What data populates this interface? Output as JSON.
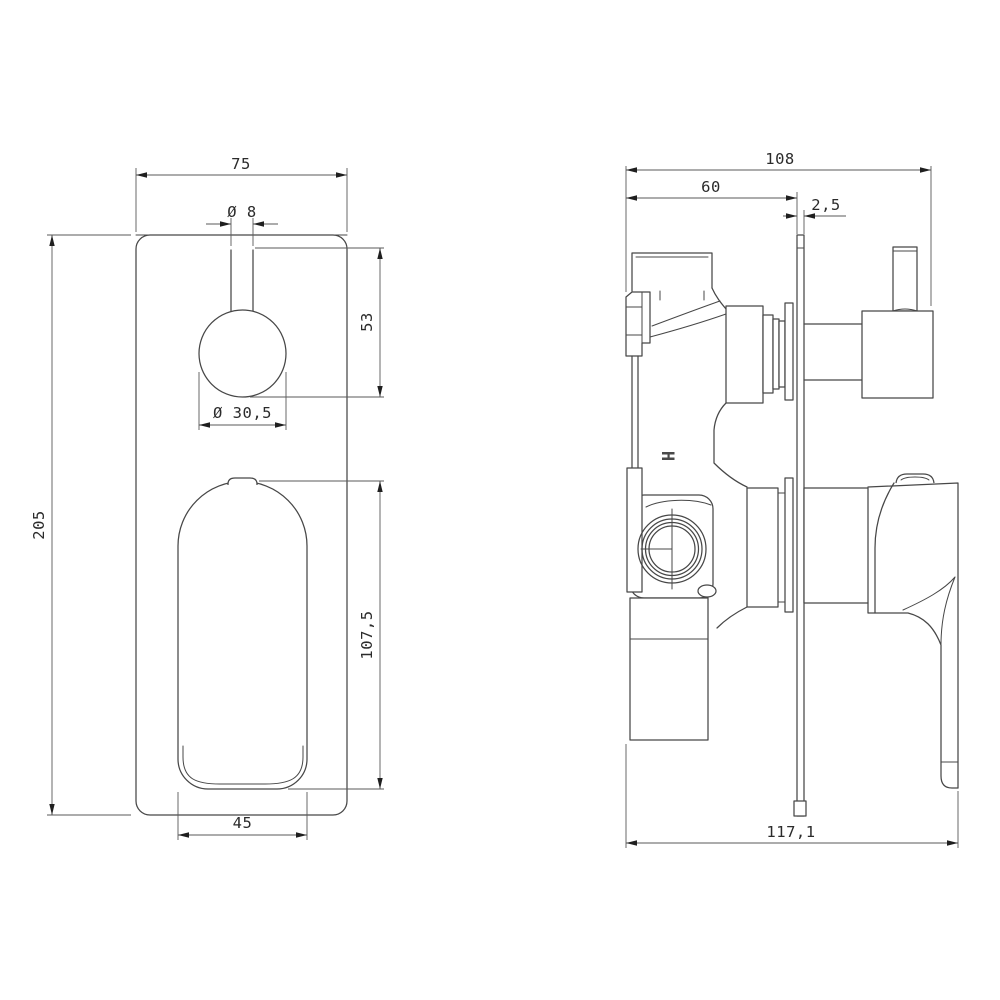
{
  "drawing": {
    "front_view": {
      "dims": {
        "plate_width": "75",
        "stem_diameter": "Ø 8",
        "stem_to_knob": "53",
        "knob_diameter": "Ø 30,5",
        "plate_height": "205",
        "lever_height": "107,5",
        "lever_width": "45"
      }
    },
    "side_view": {
      "dims": {
        "depth_to_knob": "108",
        "body_depth": "60",
        "plate_thickness": "2,5",
        "total_depth": "117,1"
      },
      "markings": {
        "hot_indicator": "H"
      }
    },
    "colors": {
      "background": "#ffffff",
      "line": "#474747",
      "dim_line": "#5a5a5a",
      "text": "#2b2b2b",
      "arrow": "#1f1f1f"
    }
  }
}
